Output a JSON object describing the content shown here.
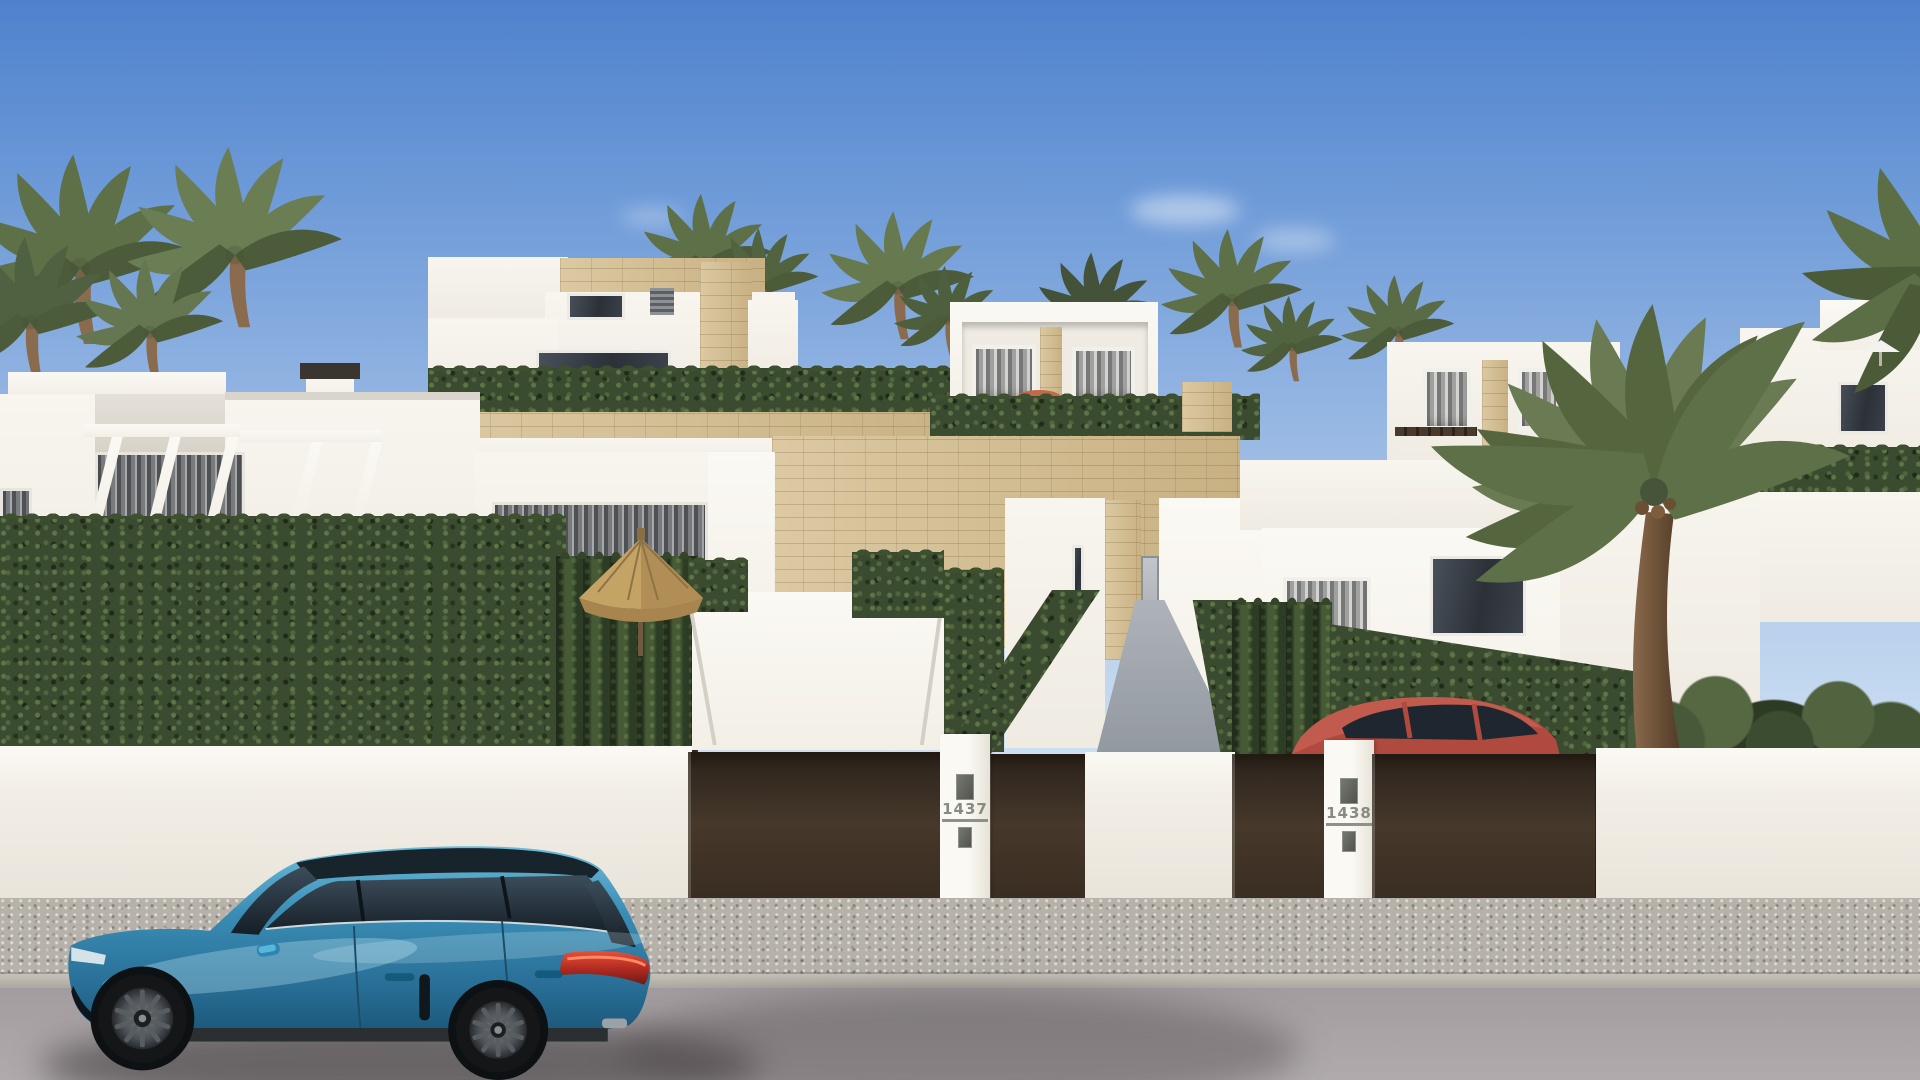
{
  "image": {
    "kind": "3d-architectural-render",
    "subject": "Street view of modern white Mediterranean villas with travertine stone accents, trimmed hedges, dark brown entrance gates, palm trees, a straw parasol, a red car parked behind one gate and a blue Porsche wagon parked on the street"
  },
  "plaques": {
    "villa_left_number": "1437",
    "villa_right_number": "1438"
  },
  "palette": {
    "sky_top": "#4e82cd",
    "sky_horizon": "#e4eef8",
    "wall_white": "#f2eee6",
    "stone_travertine": "#d3bd95",
    "gate_brown": "#3a2d22",
    "hedge_green": "#3b4b30",
    "palm_green": "#5e7047",
    "sidewalk_gray": "#b6b2a9",
    "road_gray": "#a29c9e",
    "car_blue": "#2f7fa9",
    "caliper_lime": "#b3d138",
    "taillight_red": "#c0392b",
    "red_car": "#b04a3e",
    "parasol_straw": "#c4a365"
  },
  "objects": {
    "foreground_car": "blue-porsche-wagon",
    "gated_car": "red-hatchback",
    "garden_umbrella": "straw-parasol",
    "trees": "palm-trees",
    "fence": "dark-brown-gates-with-white-pillars"
  }
}
